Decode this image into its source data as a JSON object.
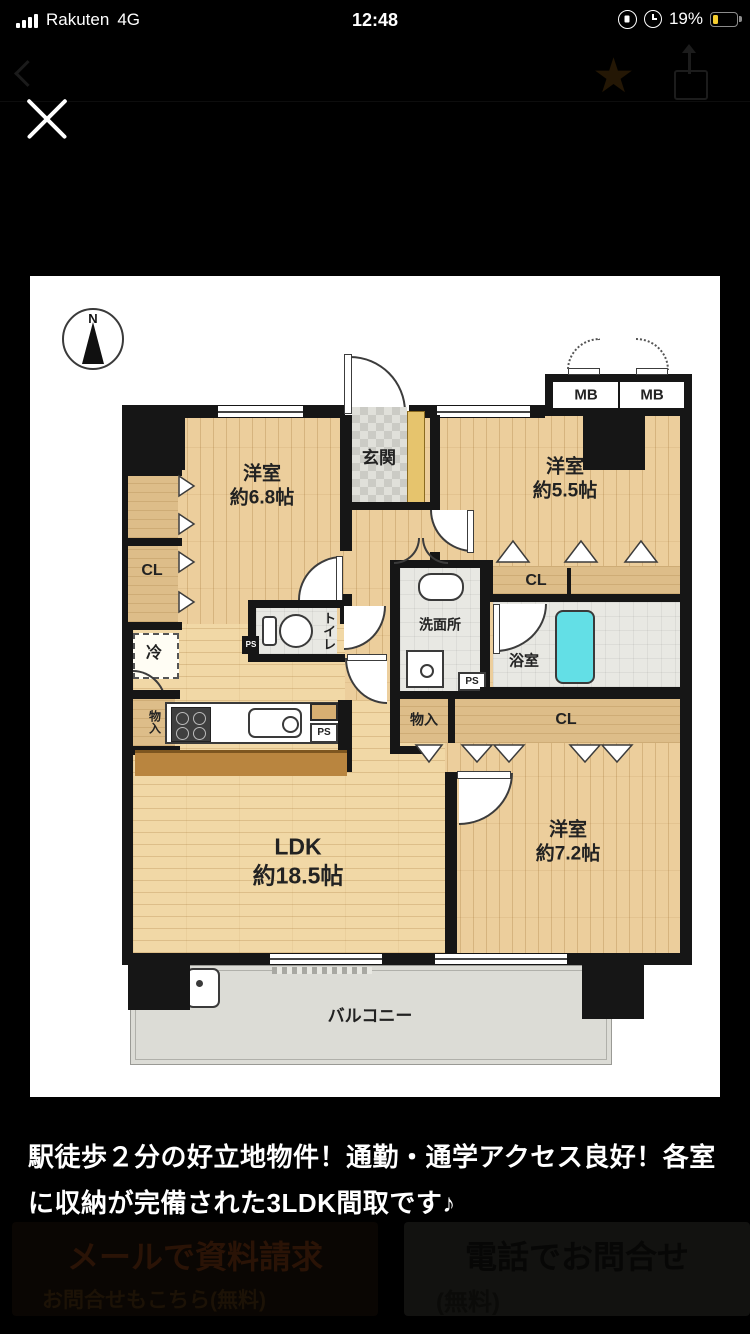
{
  "status_bar": {
    "carrier": "Rakuten",
    "network": "4G",
    "time": "12:48",
    "battery_percent": "19%",
    "battery_color": "#f6ce2f"
  },
  "floorplan": {
    "compass": "N",
    "meter_boxes": [
      "MB",
      "MB"
    ],
    "entrance": "玄関",
    "rooms": [
      {
        "name": "洋室",
        "size": "約6.8帖"
      },
      {
        "name": "洋室",
        "size": "約5.5帖"
      },
      {
        "name": "洋室",
        "size": "約7.2帖"
      },
      {
        "name": "LDK",
        "size": "約18.5帖"
      }
    ],
    "closets": {
      "left": "CL",
      "upper": "CL",
      "center": "CL",
      "storage_left": "物入",
      "storage_center": "物入",
      "fridge": "冷"
    },
    "sanitary": {
      "toilet": "トイレ",
      "washroom": "洗面所",
      "bathroom": "浴室"
    },
    "pipe_spaces": [
      "PS",
      "PS",
      "PS",
      "PS"
    ],
    "balcony": "バルコニー"
  },
  "caption": {
    "line1": "駅徒歩２分の好立地物件！通勤・通学アクセス良好！各室",
    "line2": "に収納が完備された3LDK間取です♪"
  },
  "footer": {
    "mail_button": {
      "label": "メールで資料請求",
      "sub": "お問合せもこちら(無料)"
    },
    "phone_button": {
      "label": "電話でお問合せ",
      "sub": "(無料)"
    }
  }
}
